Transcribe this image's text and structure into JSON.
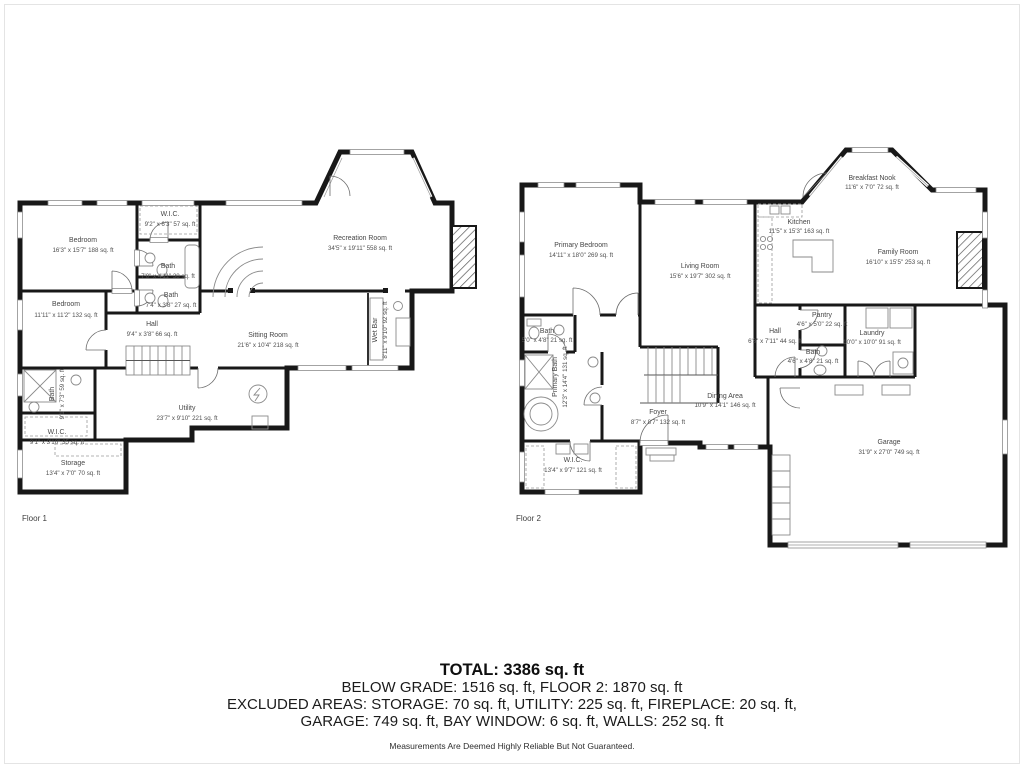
{
  "floor1": {
    "label": "Floor 1",
    "rooms": {
      "bedroom_top": {
        "name": "Bedroom",
        "dims": "16'3\" x 15'7\" 188 sq. ft"
      },
      "wic_top": {
        "name": "W.I.C.",
        "dims": "9'2\" x 6'3\" 57 sq. ft"
      },
      "bath_upper": {
        "name": "Bath",
        "dims": "7'0\" x 4'11\" 38 sq. ft"
      },
      "bath_mid": {
        "name": "Bath",
        "dims": "7'4\" x 3'8\" 27 sq. ft"
      },
      "bedroom_left": {
        "name": "Bedroom",
        "dims": "11'11\" x 11'2\" 132 sq. ft"
      },
      "hall": {
        "name": "Hall",
        "dims": "9'4\" x 3'8\" 66 sq. ft"
      },
      "recreation": {
        "name": "Recreation Room",
        "dims": "34'5\" x 19'11\" 558 sq. ft"
      },
      "sitting": {
        "name": "Sitting Room",
        "dims": "21'6\" x 10'4\" 218 sq. ft"
      },
      "wet_bar": {
        "name": "Wet Bar",
        "dims": "8'11\" x 9'10\" 92 sq. ft"
      },
      "bath_lower": {
        "name": "Bath",
        "dims": "9'1\" x 7'3\" 59 sq. ft"
      },
      "wic_lower": {
        "name": "W.I.C.",
        "dims": "9'1\" x 3'10\" 35 sq. ft"
      },
      "storage": {
        "name": "Storage",
        "dims": "13'4\" x 7'0\" 70 sq. ft"
      },
      "utility": {
        "name": "Utility",
        "dims": "23'7\" x 9'10\" 221 sq. ft"
      }
    }
  },
  "floor2": {
    "label": "Floor 2",
    "rooms": {
      "primary_bedroom": {
        "name": "Primary Bedroom",
        "dims": "14'11\" x 18'0\" 269 sq. ft"
      },
      "living_room": {
        "name": "Living Room",
        "dims": "15'6\" x 19'7\" 302 sq. ft"
      },
      "breakfast_nook": {
        "name": "Breakfast Nook",
        "dims": "11'6\" x 7'0\" 72 sq. ft"
      },
      "kitchen": {
        "name": "Kitchen",
        "dims": "11'5\" x 15'3\" 163 sq. ft"
      },
      "family_room": {
        "name": "Family Room",
        "dims": "16'10\" x 15'5\" 253 sq. ft"
      },
      "pantry": {
        "name": "Pantry",
        "dims": "4'6\" x 5'0\" 22 sq. ft"
      },
      "hall": {
        "name": "Hall",
        "dims": "6'3\" x 7'11\" 44 sq. ft"
      },
      "laundry": {
        "name": "Laundry",
        "dims": "10'0\" x 10'0\" 91 sq. ft"
      },
      "bath_right": {
        "name": "Bath",
        "dims": "4'6\" x 4'8\" 21 sq. ft"
      },
      "bath_left": {
        "name": "Bath",
        "dims": "5'0\" x 4'8\" 21 sq. ft"
      },
      "primary_bath": {
        "name": "Primary Bath",
        "dims": "12'3\" x 14'4\" 131 sq. ft"
      },
      "wic": {
        "name": "W.I.C.",
        "dims": "13'4\" x 9'7\" 121 sq. ft"
      },
      "foyer": {
        "name": "Foyer",
        "dims": "8'7\" x 8'7\" 132 sq. ft"
      },
      "dining_area": {
        "name": "Dining Area",
        "dims": "10'9\" x 14'1\" 146 sq. ft"
      },
      "garage": {
        "name": "Garage",
        "dims": "31'9\" x 27'0\" 749 sq. ft"
      }
    }
  },
  "summary": {
    "total": "TOTAL: 3386 sq. ft",
    "line2": "BELOW GRADE: 1516 sq. ft, FLOOR 2: 1870 sq. ft",
    "line3": "EXCLUDED AREAS: STORAGE: 70 sq. ft, UTILITY: 225 sq. ft, FIREPLACE: 20 sq. ft,",
    "line4": "GARAGE: 749 sq. ft, BAY WINDOW: 6 sq. ft, WALLS: 252 sq. ft",
    "disclaimer": "Measurements Are Deemed Highly Reliable But Not Guaranteed."
  },
  "colors": {
    "wall": "#181818",
    "label_text": "#474747",
    "summary_text": "#1b1b1b"
  }
}
